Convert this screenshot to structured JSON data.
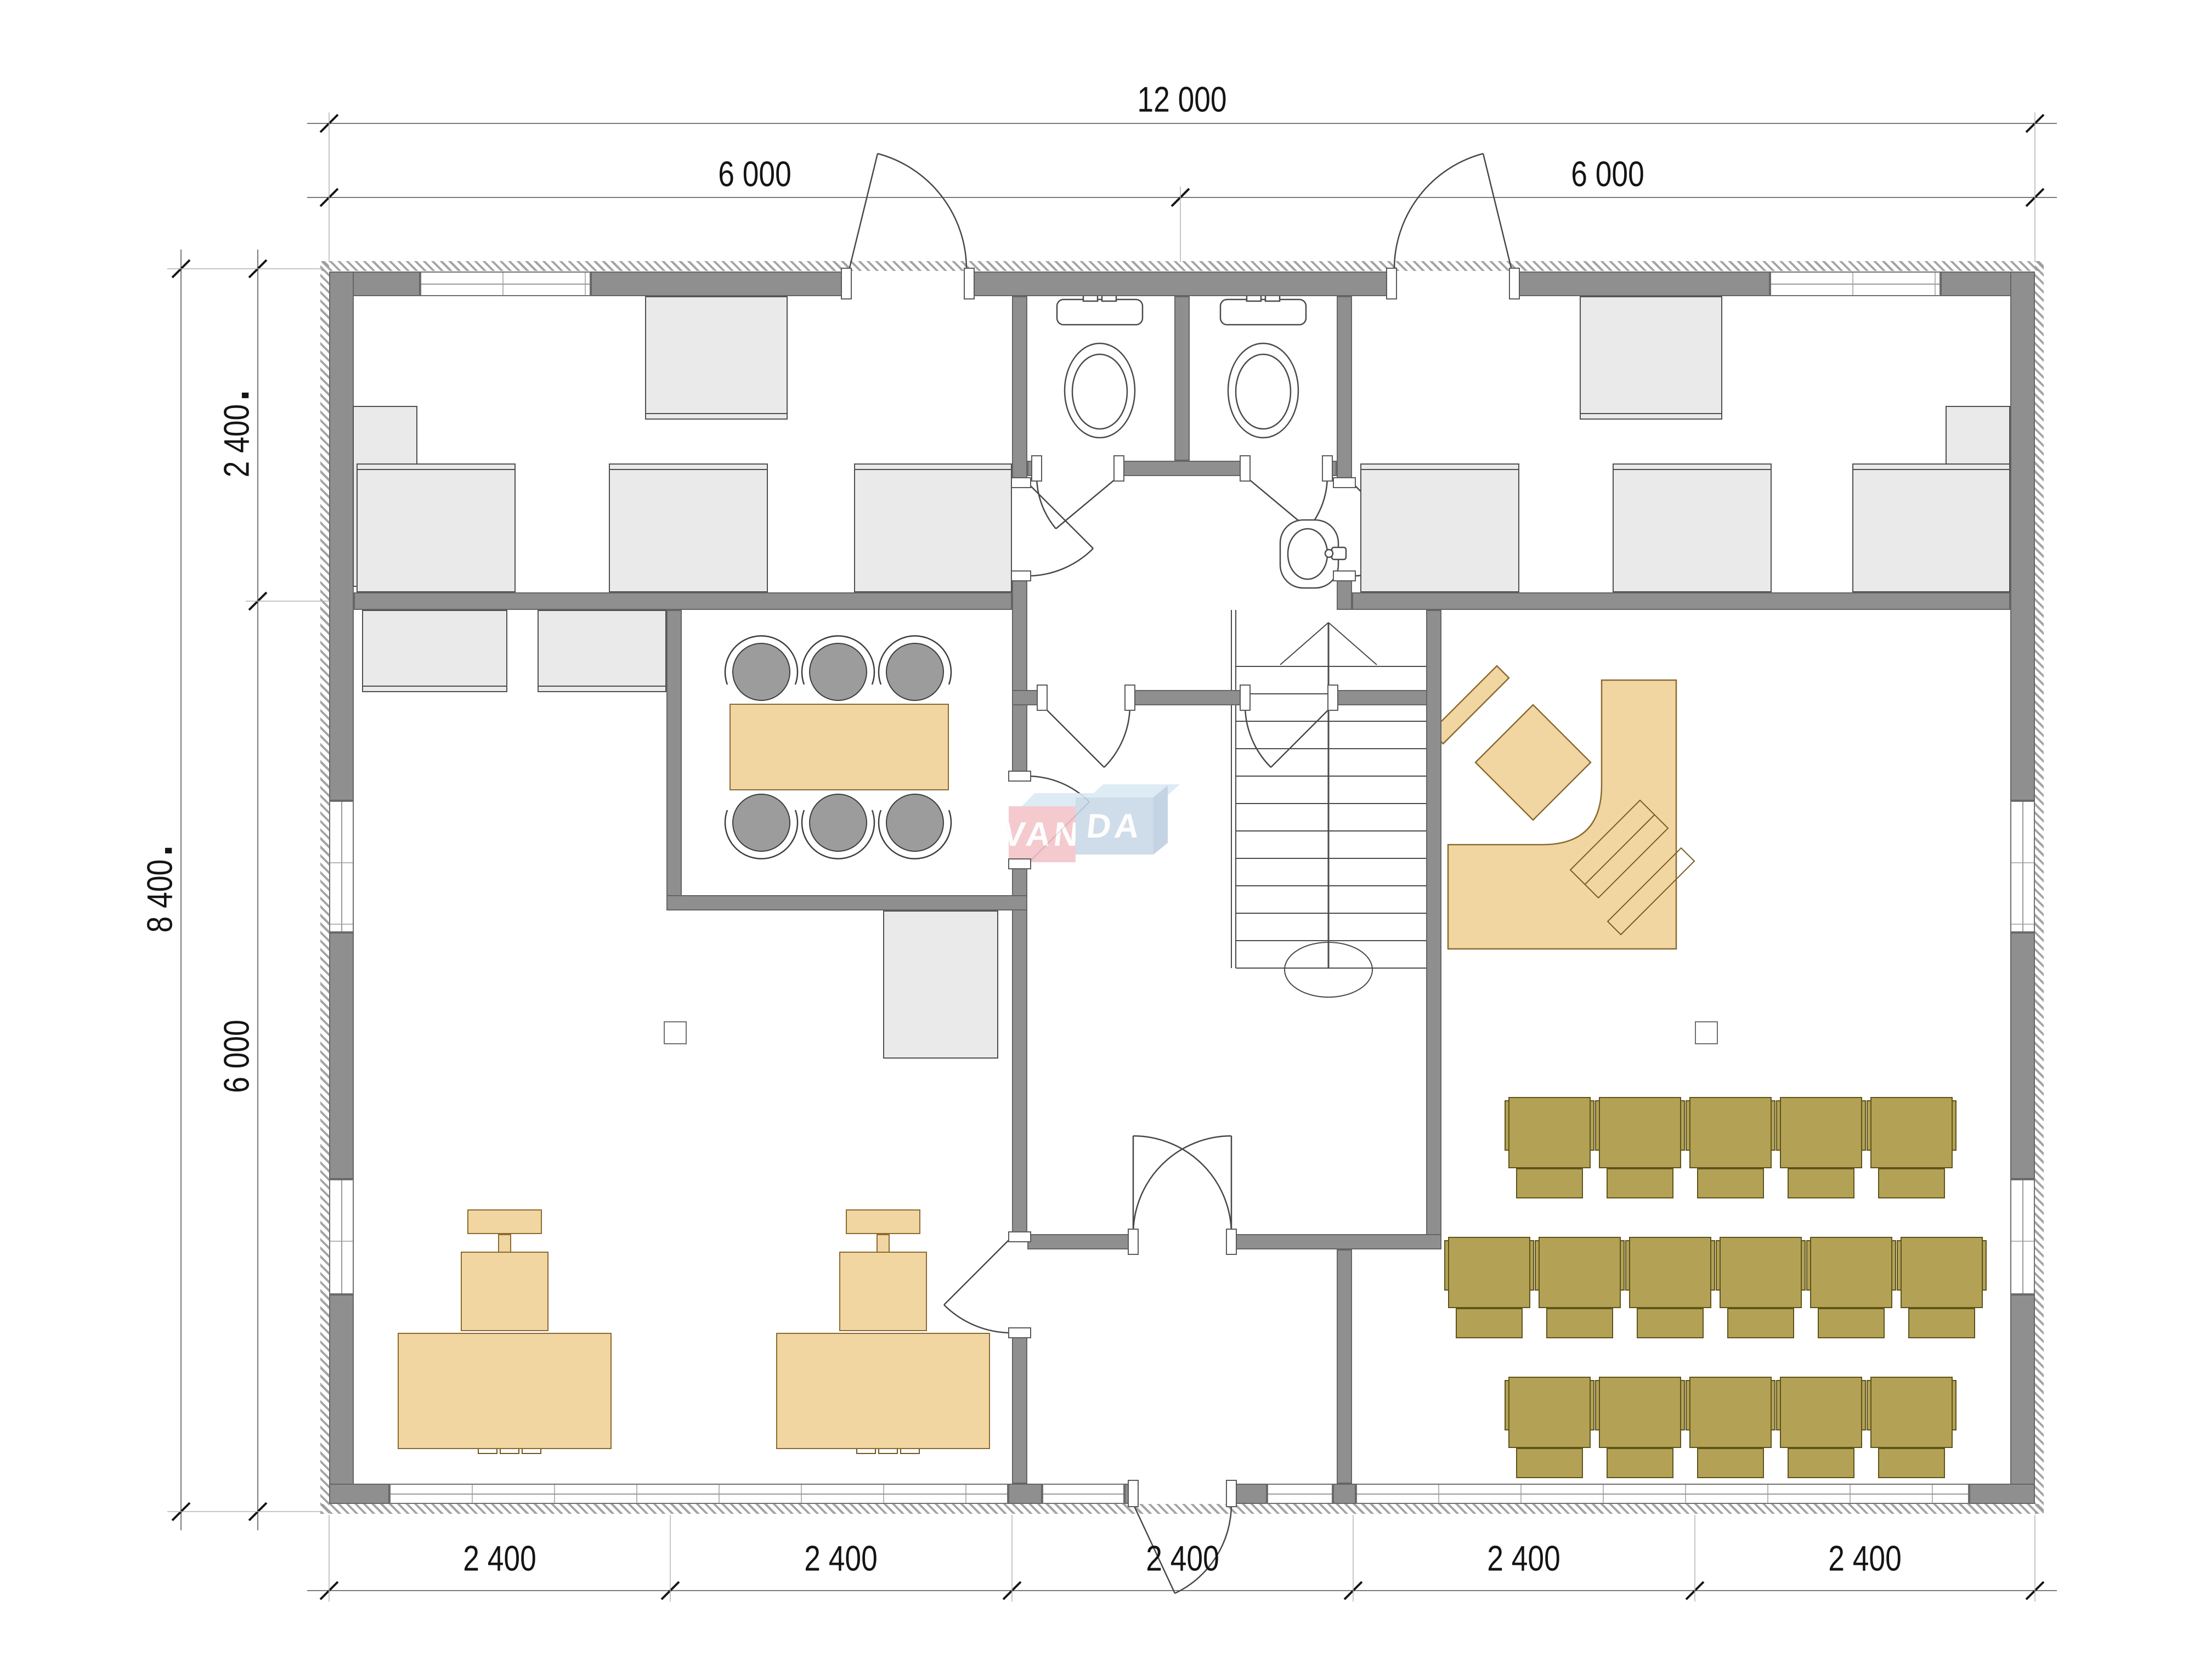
{
  "drawing": {
    "type": "architectural floor plan",
    "watermark": {
      "left": "VAN",
      "right": "DA"
    }
  },
  "dimensions": {
    "top_total": "12 000",
    "top_left_half": "6 000",
    "top_right_half": "6 000",
    "side_total": "8 400",
    "side_upper": "2 400",
    "side_lower": "6 000",
    "bottom": [
      "2 400",
      "2 400",
      "2 400",
      "2 400",
      "2 400"
    ]
  },
  "colors": {
    "wall": "#8f8f8f",
    "furniture_light_gray": "#eaeaea",
    "furniture_wood": "#f2d6a2",
    "audience_chair_olive": "#b3a255",
    "meeting_chair_gray": "#9c9c9c",
    "watermark_pink": "#f3c3c9",
    "watermark_blue": "#c9d8e8",
    "dimension_text": "#141414"
  },
  "icons": {
    "toilet": "toilet-icon",
    "sink": "sink-icon",
    "stairs": "stairs-up-arrow",
    "computer": "computer-icon",
    "office_chair": "office-chair-icon",
    "door_swing": "door-swing-arc"
  }
}
